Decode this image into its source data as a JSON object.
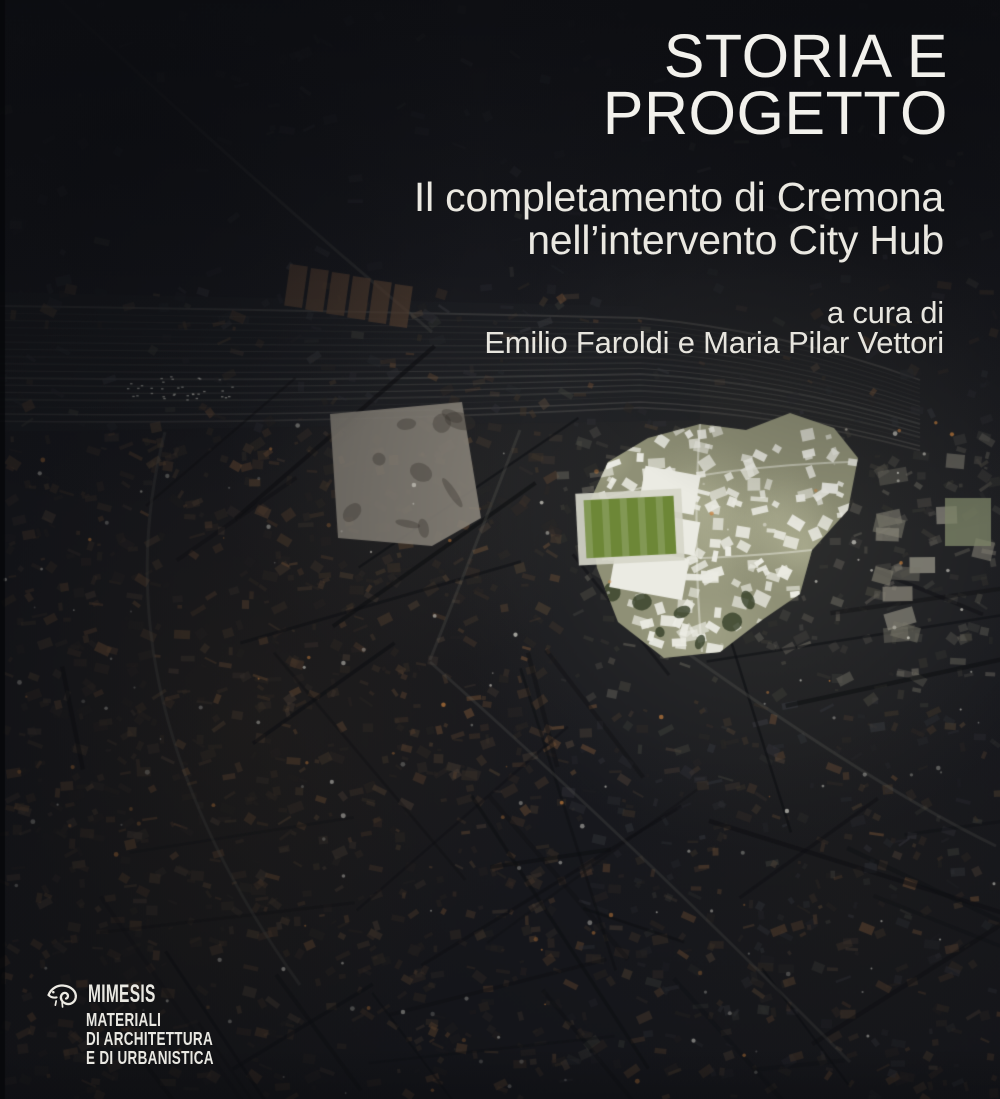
{
  "cover": {
    "title": {
      "line1": "STORIA E",
      "line2": "PROGETTO"
    },
    "subtitle": {
      "line1": "Il completamento di Cremona",
      "line2": "nell’intervento City Hub"
    },
    "byline": {
      "prefix": "a cura di",
      "authors": "Emilio Faroldi e Maria Pilar Vettori"
    },
    "publisher": {
      "name": "MIMESIS",
      "series": [
        "MATERIALI",
        "DI ARCHITETTURA",
        "E DI URBANISTICA"
      ],
      "logo_icon": "chameleon-icon"
    }
  },
  "image": {
    "colors": {
      "base": "#191a1f",
      "lot": "#8f8a7f",
      "plan_ground": "#8f9076",
      "plan_building": "#ebebe3",
      "field_green": "#6d8737",
      "roof_brown": "#52453a",
      "accent_text": "#f1efe9"
    }
  }
}
